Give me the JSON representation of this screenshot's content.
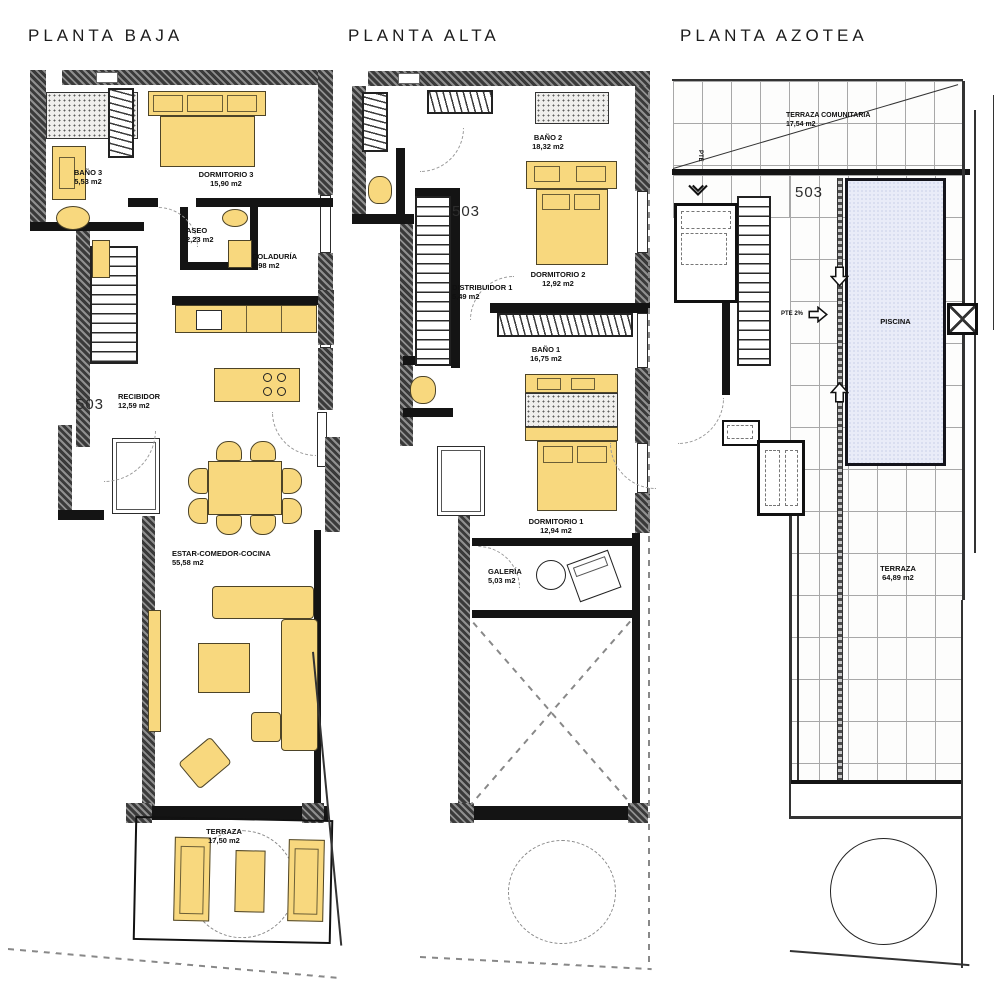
{
  "plans": {
    "baja": {
      "title": "PLANTA BAJA",
      "unit": "503",
      "rooms": {
        "bano3": {
          "name": "BAÑO 3",
          "area": "5,53 m2"
        },
        "dormitorio3": {
          "name": "DORMITORIO 3",
          "area": "15,90 m2"
        },
        "aseo": {
          "name": "ASEO",
          "area": "2,23 m2"
        },
        "coladuria": {
          "name": "COLADURÍA",
          "area": "6,98 m2"
        },
        "recibidor": {
          "name": "RECIBIDOR",
          "area": "12,59 m2"
        },
        "estar": {
          "name": "ESTAR-COMEDOR-COCINA",
          "area": "55,58 m2"
        },
        "terraza": {
          "name": "TERRAZA",
          "area": "17,50 m2"
        }
      }
    },
    "alta": {
      "title": "PLANTA ALTA",
      "unit": "503",
      "rooms": {
        "bano2": {
          "name": "BAÑO 2",
          "area": "18,32 m2"
        },
        "dormitorio2": {
          "name": "DORMITORIO 2",
          "area": "12,92 m2"
        },
        "distribuidor1": {
          "name": "DISTRIBUIDOR 1",
          "area": "5,49 m2"
        },
        "bano1": {
          "name": "BAÑO 1",
          "area": "16,75 m2"
        },
        "dormitorio1": {
          "name": "DORMITORIO 1",
          "area": "12,94 m2"
        },
        "galeria": {
          "name": "GALERÍA",
          "area": "5,03 m2"
        }
      }
    },
    "azotea": {
      "title": "PLANTA AZOTEA",
      "unit": "503",
      "rooms": {
        "terraza_comunitaria": {
          "name": "TERRAZA COMUNITARIA",
          "area": "17,54 m2"
        },
        "piscina": {
          "name": "PISCINA"
        },
        "terraza": {
          "name": "TERRAZA",
          "area": "64,89 m2"
        }
      },
      "annotations": {
        "slope_right": "PTE 2%",
        "slope_top": "PTE"
      }
    }
  },
  "colors": {
    "furniture": "#f8d87e",
    "wall": "#3a3a3a",
    "pool": "#e9ecf8"
  }
}
